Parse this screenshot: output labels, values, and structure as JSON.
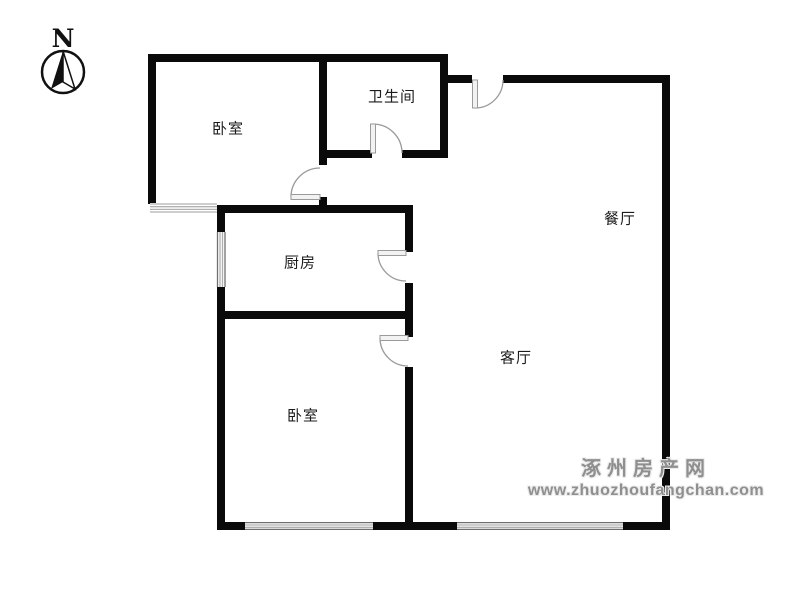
{
  "compass": {
    "label": "N"
  },
  "rooms": [
    {
      "id": "bedroom-top",
      "label": "卧室"
    },
    {
      "id": "bathroom",
      "label": "卫生间"
    },
    {
      "id": "kitchen",
      "label": "厨房"
    },
    {
      "id": "dining",
      "label": "餐厅"
    },
    {
      "id": "living",
      "label": "客厅"
    },
    {
      "id": "bedroom-bottom",
      "label": "卧室"
    }
  ],
  "watermark": {
    "site_name": "涿州房产网",
    "site_url": "www.zhuozhoufangchan.com"
  },
  "colors": {
    "wall": "#0a0a0a",
    "door_arc": "#9a9a9a",
    "window_line": "#b0b0b0",
    "watermark_text": "#8f8f8f",
    "background": "#ffffff"
  }
}
